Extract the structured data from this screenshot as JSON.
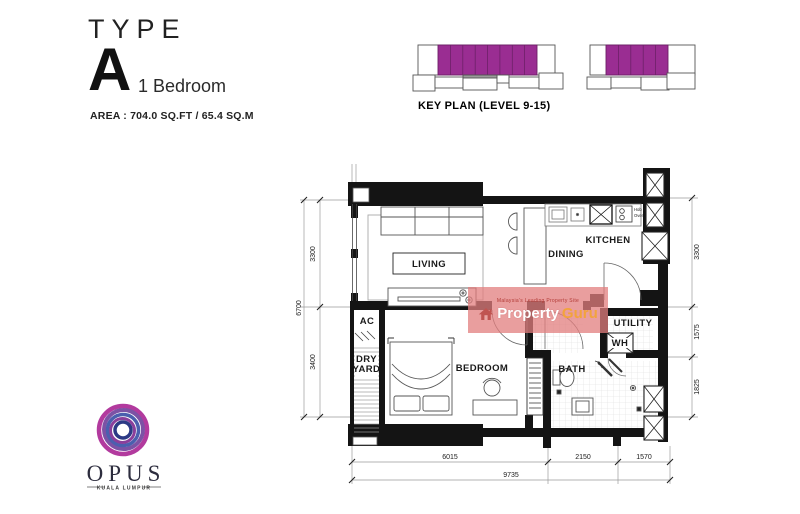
{
  "title": {
    "eyebrow": "TYPE",
    "letter": "A",
    "subtitle": "1 Bedroom",
    "area": "AREA : 704.0 SQ.FT / 65.4 SQ.M"
  },
  "key_plan": {
    "caption": "KEY PLAN (LEVEL 9-15)"
  },
  "plan": {
    "rooms": {
      "living": "LIVING",
      "dining": "DINING",
      "kitchen": "KITCHEN",
      "ac": "AC",
      "dry": "DRY",
      "yard": "YARD",
      "bedroom": "BEDROOM",
      "bath": "BATH",
      "utility": "UTILITY"
    },
    "labels": {
      "wh": "WH",
      "hob_line1": "Hob &",
      "hob_line2": "Oven"
    },
    "dims": {
      "left_top": "3300",
      "left_overall": "6700",
      "left_bottom": "3400",
      "right_top": "3300",
      "right_mid": "1575",
      "right_bottom": "1825",
      "bottom_seg1": "6015",
      "bottom_seg2": "2150",
      "bottom_seg3": "1570",
      "bottom_total": "9735"
    }
  },
  "watermark": {
    "tagline": "Malaysia's Leading Property Site",
    "brand_1": "Property",
    "brand_2": "Guru"
  },
  "logo": {
    "brand": "OPUS",
    "city": "KUALA LUMPUR"
  },
  "colors": {
    "highlight_purple": "#9a2d92",
    "watermark_pink": "rgba(226,125,125,0.75)",
    "guru_orange": "#f2a33c"
  }
}
